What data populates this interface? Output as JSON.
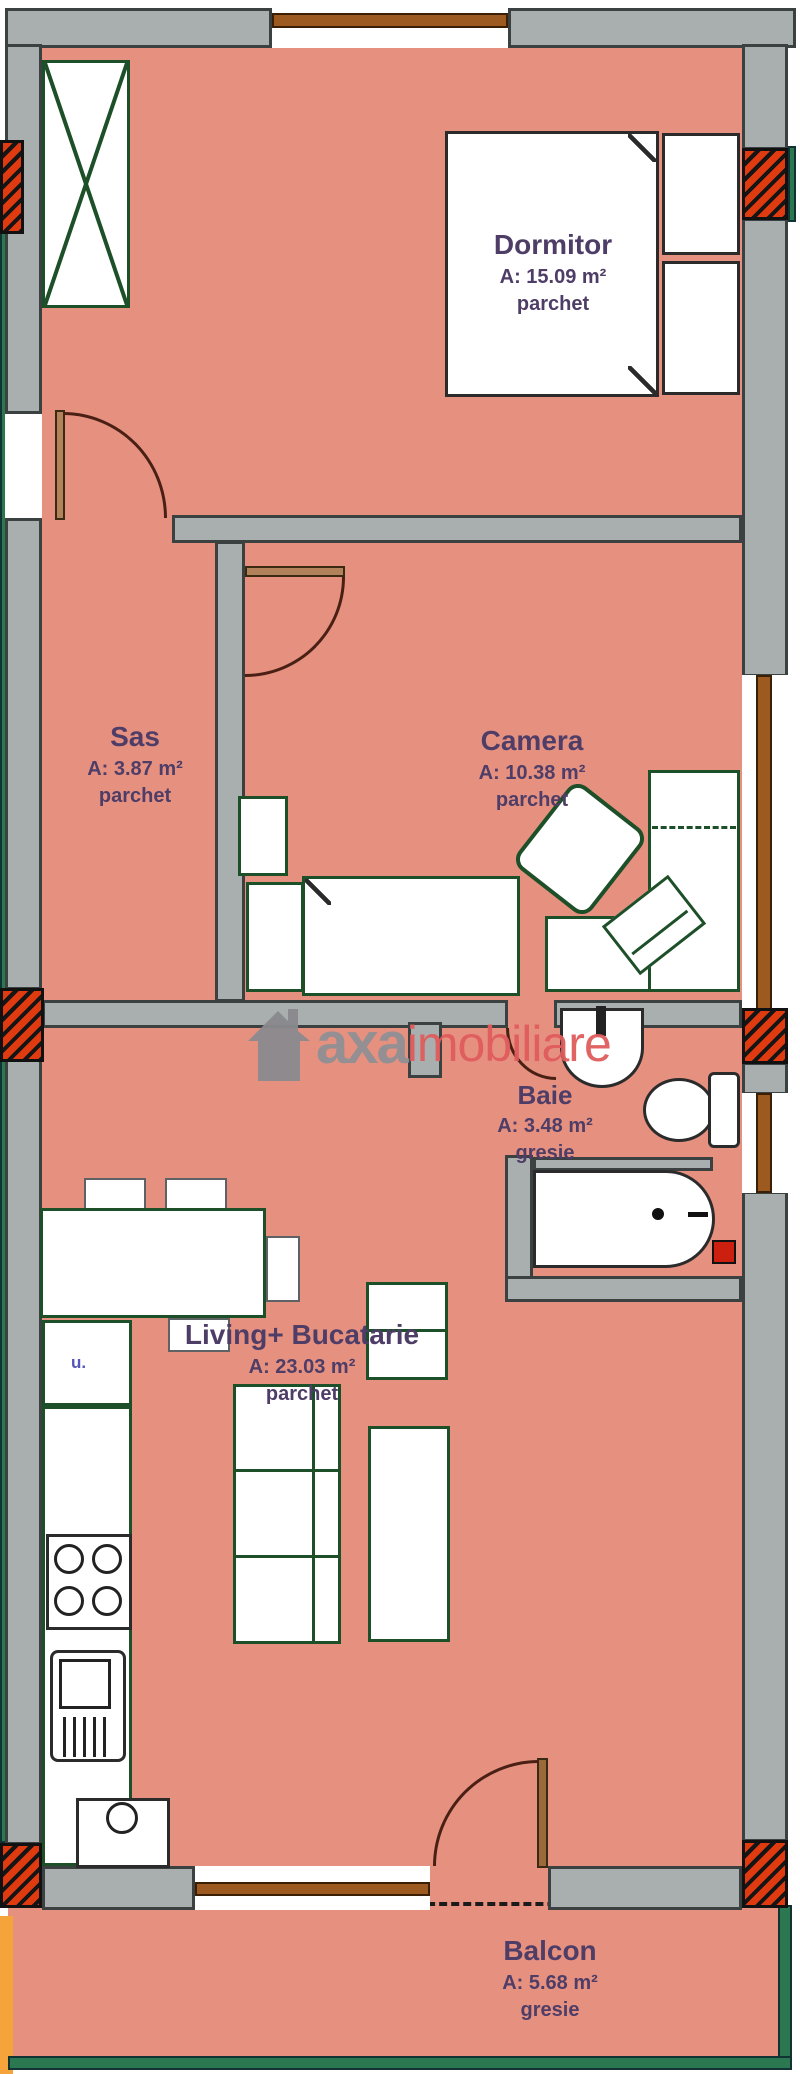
{
  "watermark": {
    "brand": "axa",
    "brand_suffix": "imobiliare"
  },
  "rooms": {
    "dormitor": {
      "name": "Dormitor",
      "area": "A: 15.09 m²",
      "floor": "parchet"
    },
    "sas": {
      "name": "Sas",
      "area": "A: 3.87 m²",
      "floor": "parchet"
    },
    "camera": {
      "name": "Camera",
      "area": "A: 10.38 m²",
      "floor": "parchet"
    },
    "baie": {
      "name": "Baie",
      "area": "A: 3.48 m²",
      "floor": "gresie"
    },
    "living": {
      "name": "Living+ Bucatarie",
      "area": "A: 23.03 m²",
      "floor": "parchet"
    },
    "balcon": {
      "name": "Balcon",
      "area": "A: 5.68 m²",
      "floor": "gresie"
    }
  },
  "annotations": {
    "washer": "u."
  },
  "colors": {
    "floor_salmon": "#e69180",
    "wall_gray": "#a9aeae",
    "furniture_outline_green": "#1d4f28",
    "section_hatch_red": "#e03a10",
    "exterior_green": "#2a7750",
    "balcony_edge_orange": "#f5a43b",
    "window_frame_brown": "#9c5a20",
    "label_text_purple": "#4e3d66",
    "watermark_gray": "#8f8f93",
    "watermark_red": "#e05c5c"
  }
}
